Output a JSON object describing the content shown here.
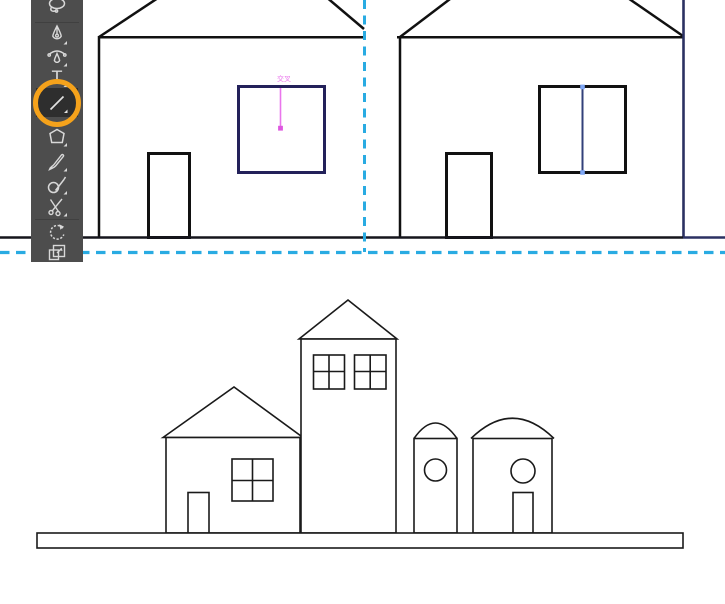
{
  "app": {
    "name": "vector-editor-workspace",
    "background": "#ffffff"
  },
  "colors": {
    "toolbar_bg": "#4d4d4d",
    "toolbar_icon": "#d8d8d8",
    "tool_selected_bg": "#2e2e2e",
    "highlight_ring_orange": "#F5A21B",
    "guide_dash_cyan": "#29ABE2",
    "smart_guide_magenta": "#EA75EC",
    "artwork_stroke_black": "#111111",
    "selected_stroke_navy": "#23215A",
    "wall_stroke_navy": "#2B3162",
    "anchor_handle_blue": "#7FA7F5"
  },
  "toolbar": {
    "type_glyph": "T",
    "tools": [
      {
        "id": "lasso",
        "name": "Lasso Tool",
        "selected": false
      },
      {
        "id": "pen",
        "name": "Pen Tool",
        "selected": false
      },
      {
        "id": "curvature",
        "name": "Curvature Tool",
        "selected": false
      },
      {
        "id": "type",
        "name": "Type Tool",
        "selected": false
      },
      {
        "id": "line-segment",
        "name": "Line Segment Tool",
        "selected": true,
        "highlighted_with_orange_ring": true
      },
      {
        "id": "eraser",
        "name": "Eraser Tool",
        "selected": false
      },
      {
        "id": "paintbrush",
        "name": "Paintbrush Tool",
        "selected": false
      },
      {
        "id": "blob-brush",
        "name": "Blob Brush Tool",
        "selected": false
      },
      {
        "id": "scissors",
        "name": "Scissors Tool",
        "selected": false
      },
      {
        "id": "rotate",
        "name": "Rotate Tool",
        "selected": false
      },
      {
        "id": "artboard",
        "name": "Artboard Tool",
        "selected": false
      }
    ]
  },
  "canvas_top": {
    "description": "Two outlined houses drawn on an artboard bounded by dashed cyan guides",
    "smart_guide_label": "交叉",
    "houses": [
      {
        "name": "house-left",
        "elements": [
          "roof",
          "left-wall",
          "door",
          "navy-square-window",
          "magenta-line-being-drawn"
        ]
      },
      {
        "name": "house-right",
        "elements": [
          "roof",
          "left-wall",
          "navy-right-wall",
          "door",
          "window-with-navy-center-divider-and-anchor-dots"
        ]
      }
    ],
    "guides": {
      "vertical_guide_x": 364,
      "horizontal_guide_y": 252,
      "style": "dashed",
      "color": "#29ABE2"
    },
    "ground_line_y": 237
  },
  "canvas_bottom": {
    "description": "Finished line-art town on a base platform",
    "buildings": [
      {
        "name": "gable-house",
        "elements": [
          "triangle-roof",
          "four-pane-window",
          "door"
        ]
      },
      {
        "name": "tower",
        "elements": [
          "triangle-roof",
          "two-four-pane-windows"
        ]
      },
      {
        "name": "silo",
        "elements": [
          "shallow-dome",
          "round-window"
        ]
      },
      {
        "name": "dome-house",
        "elements": [
          "dome",
          "round-window",
          "door"
        ]
      }
    ],
    "platform": "long thin rectangle base"
  }
}
